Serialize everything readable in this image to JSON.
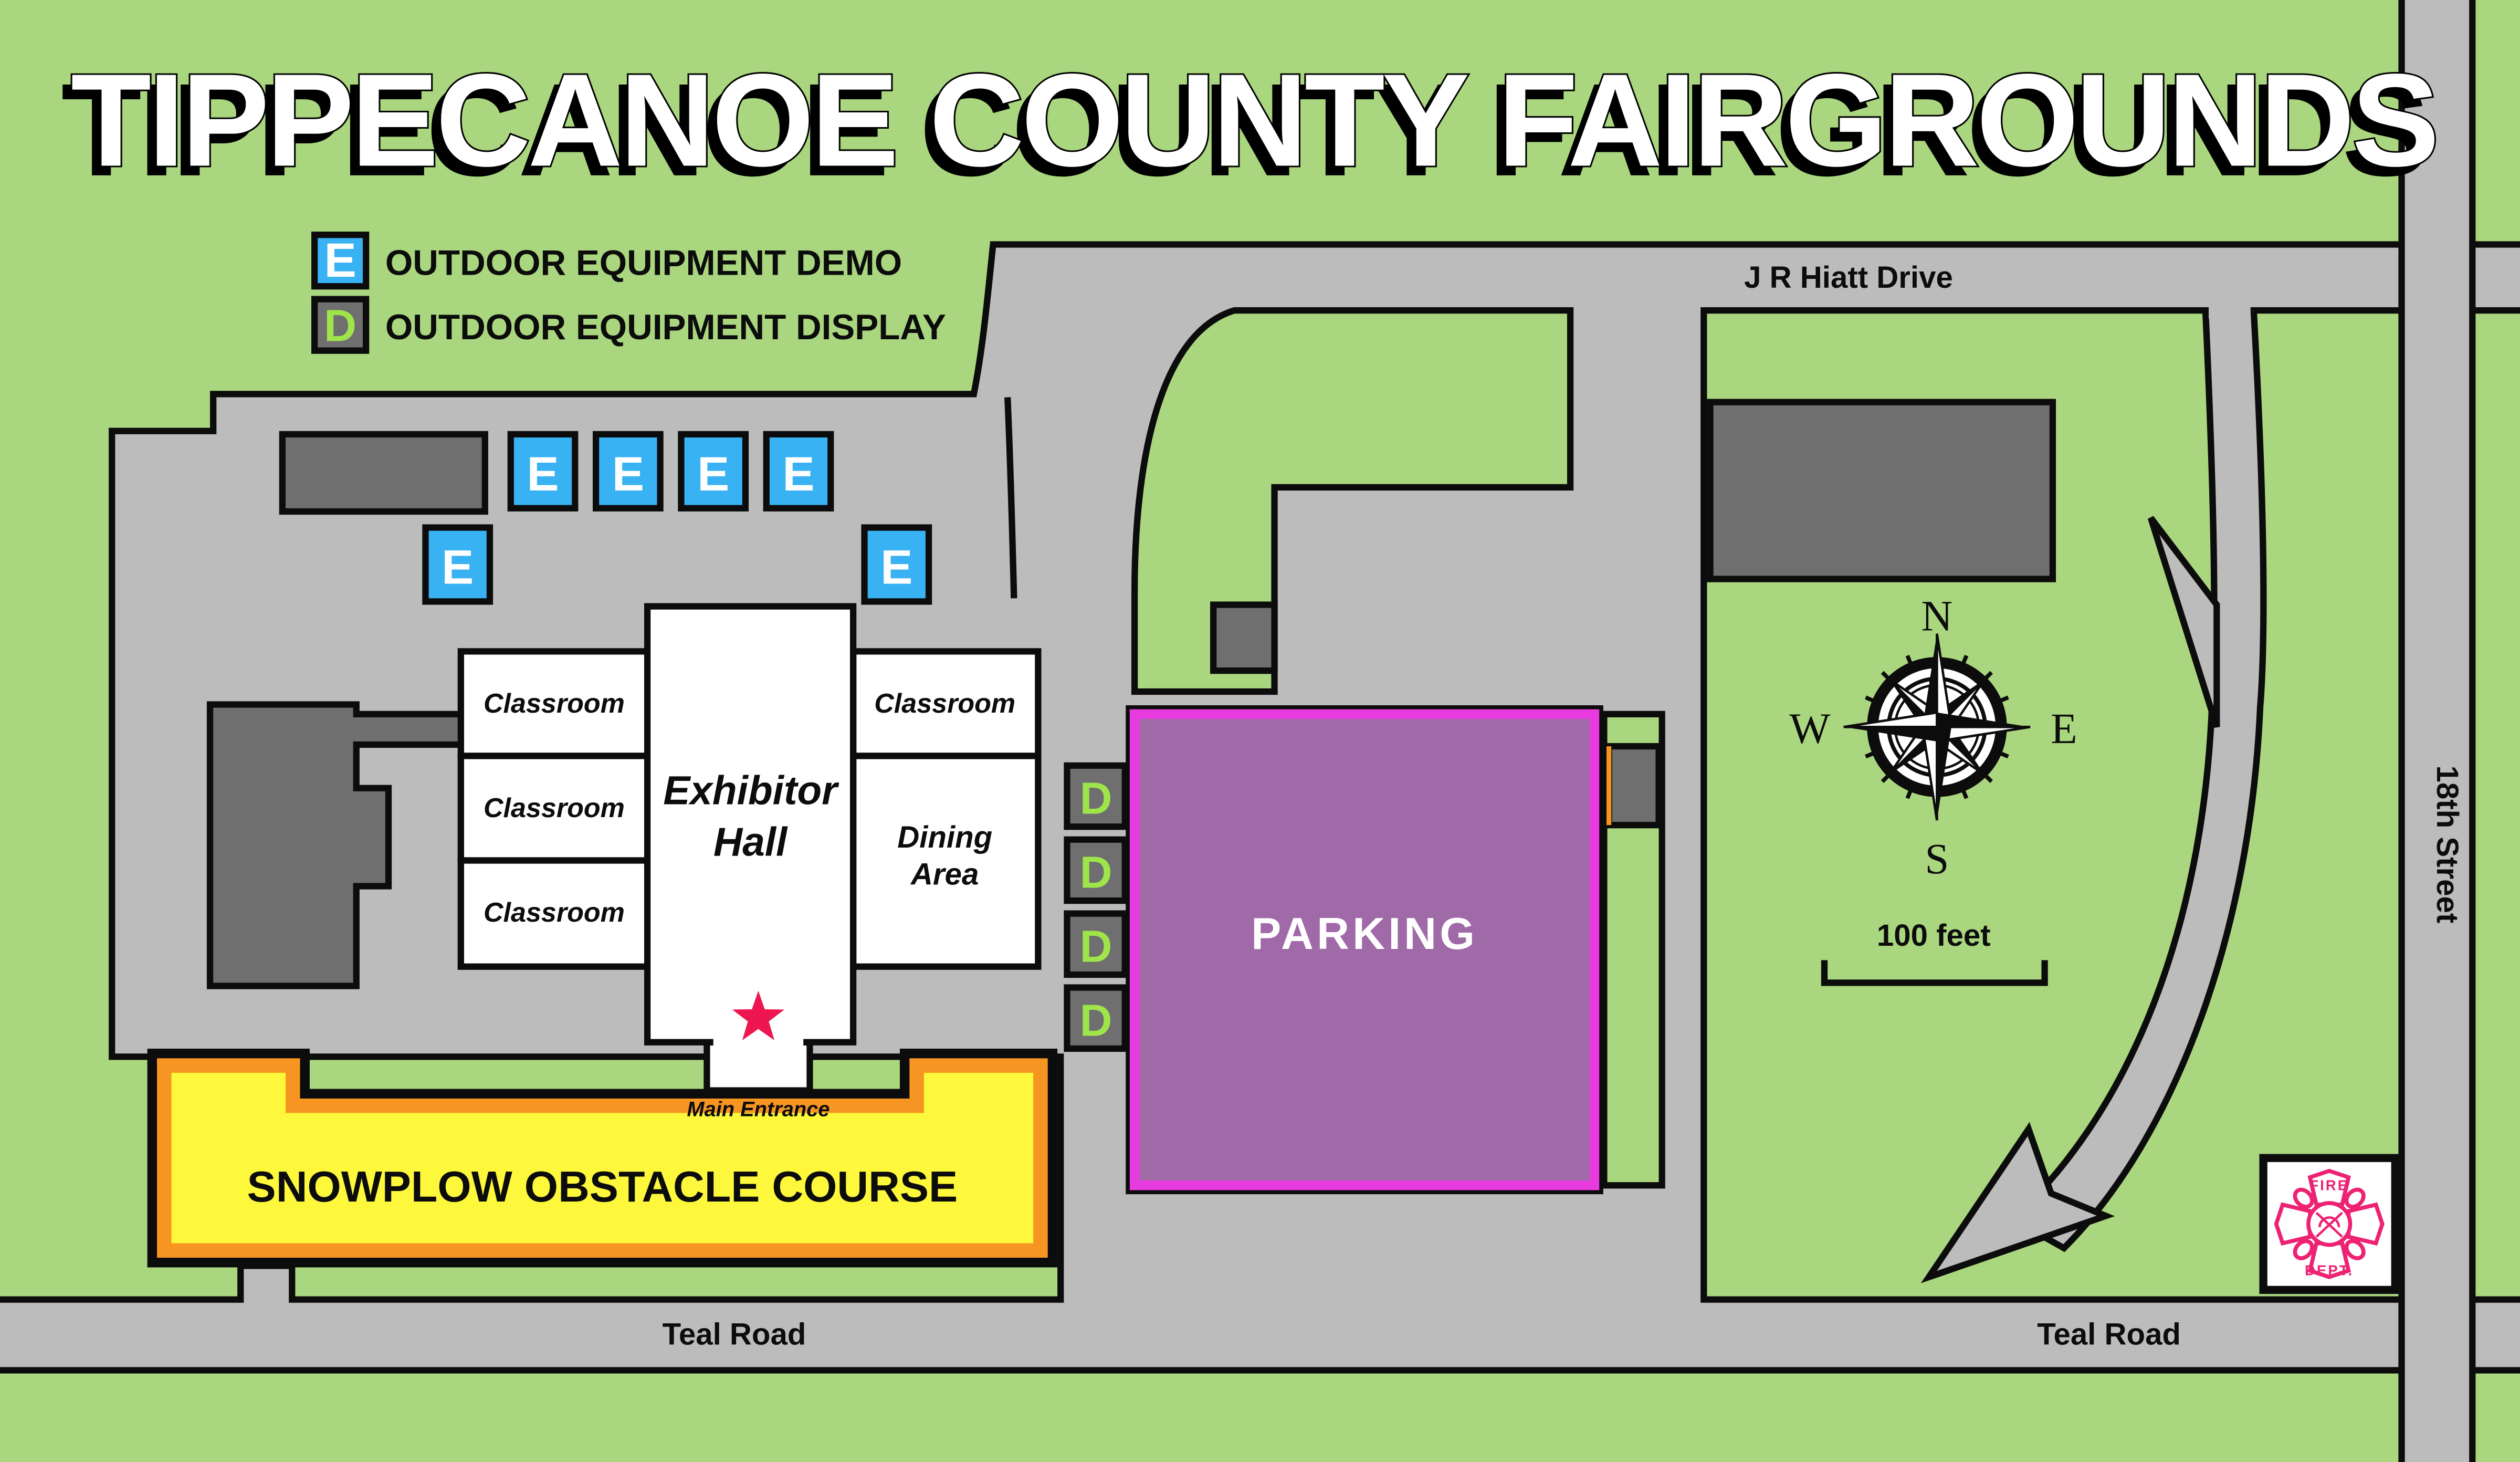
{
  "title": "TIPPECANOE COUNTY FAIRGROUNDS",
  "legend": {
    "demo": {
      "symbol": "E",
      "label": "OUTDOOR EQUIPMENT DEMO"
    },
    "display": {
      "symbol": "D",
      "label": "OUTDOOR EQUIPMENT DISPLAY"
    }
  },
  "roads": {
    "jr_hiatt": "J R Hiatt Drive",
    "teal": "Teal Road",
    "eighteenth": "18th Street"
  },
  "buildings": {
    "classroom": "Classroom",
    "exhibitor_line1": "Exhibitor",
    "exhibitor_line2": "Hall",
    "dining_line1": "Dining",
    "dining_line2": "Area"
  },
  "areas": {
    "parking": "PARKING",
    "snowplow": "SNOWPLOW OBSTACLE COURSE"
  },
  "entrance": {
    "label": "Main Entrance"
  },
  "markers": {
    "demo": "E",
    "display": "D"
  },
  "compass": {
    "n": "N",
    "e": "E",
    "s": "S",
    "w": "W"
  },
  "scale": {
    "label": "100 feet"
  },
  "fire": {
    "line1": "FIRE",
    "line2": "DEPT."
  },
  "colors": {
    "grass": "#a9d67e",
    "road": "#bcbcbc",
    "ink": "#0c0c0c",
    "dark": "#6f6f6f",
    "eblue": "#38b2f2",
    "dletter": "#9fe44a",
    "purple": "#a06aa8",
    "magenta": "#e73bdf",
    "yellow": "#fdf83b",
    "orange": "#f79522",
    "star": "#ed1650",
    "fire": "#ee2273"
  }
}
